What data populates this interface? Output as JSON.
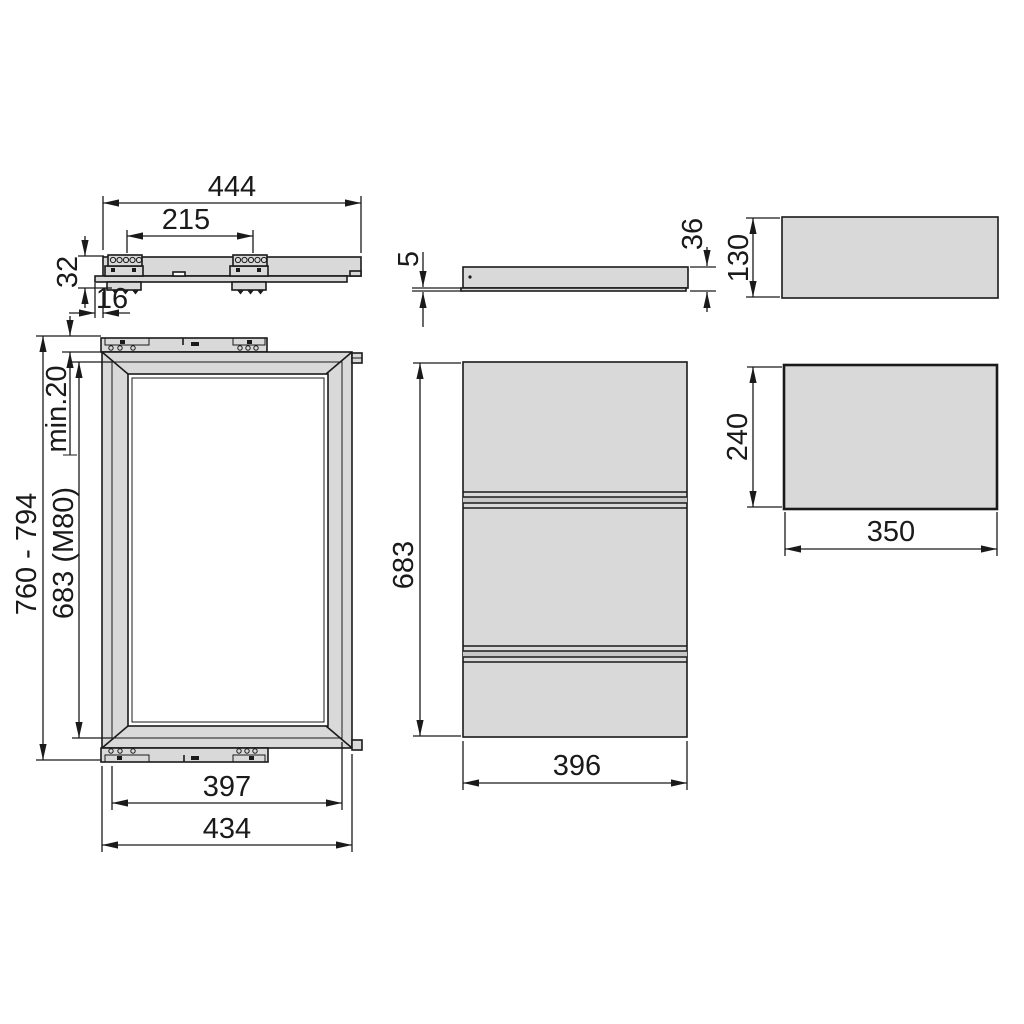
{
  "dims": {
    "rail_side": {
      "total_length": "444",
      "bracket_spacing": "215",
      "height": "32",
      "front_offset": "16"
    },
    "panel_side": {
      "edge_thickness": "5",
      "thickness": "36"
    },
    "top_slab": {
      "depth": "130"
    },
    "frame_front": {
      "overall_height": "760 - 794",
      "top_clearance": "min.20",
      "frame_height": "683 (M80)",
      "inner_width": "397",
      "overall_width": "434"
    },
    "panel_front": {
      "height": "683",
      "width": "396"
    },
    "side_slab": {
      "height": "240",
      "width": "350"
    }
  },
  "colors": {
    "line": "#1a1a1a",
    "fill_light": "#d9d9d9",
    "fill_mid": "#c6c6c6",
    "background": "#ffffff"
  }
}
